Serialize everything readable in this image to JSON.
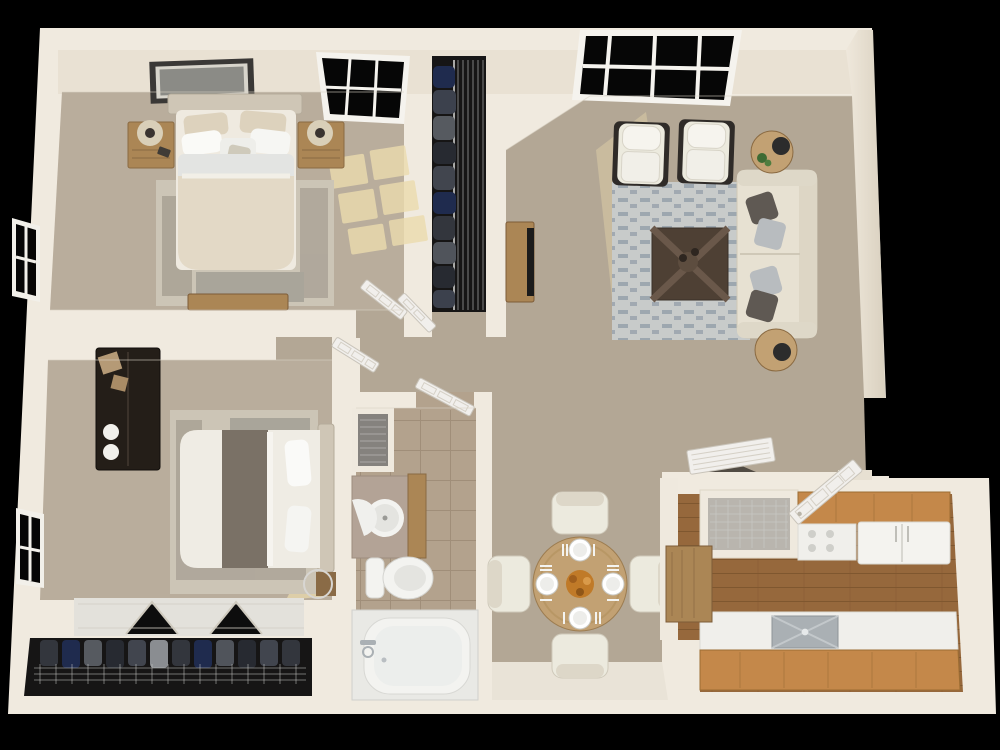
{
  "scene": {
    "description": "Photorealistic 3D dollhouse-style top-down floor plan render of a two-bedroom, one-bathroom apartment on a black background",
    "view": "overhead 3D floor plan",
    "bedrooms": 2,
    "bathrooms": 1,
    "background": "#000000"
  },
  "palette": {
    "background": "#000000",
    "wall": "#f0eadf",
    "wall_face": "#e9e1d3",
    "wall_shade": "#ddd4c3",
    "carpet": "#b3a795",
    "carpet_bedroom": "#b9ad9c",
    "vinyl": "#e9e3d7",
    "tile": "#b3a28d",
    "rug_bedroom": "#ccc5b6",
    "rug_living": "#c8cbca",
    "rug_pattern": "#8f9aa5",
    "wood_floor": "#96683c",
    "cabinet_wood": "#c4884a",
    "counter": "#f0efeb",
    "wood_light": "#c2a173",
    "wood_mid": "#ab8655",
    "table_dark": "#4e4034",
    "armoire": "#241e18",
    "closet_dark": "#161515",
    "sofa": "#e7e1d2",
    "chair": "#eceade",
    "pillow_dark": "#5f5953",
    "pillow_light": "#b8bcbf",
    "fixture": "#f3f3f0",
    "steel": "#aab0b4",
    "door": "#f1efec",
    "sunlight": "#ecdcae",
    "plant": "#3e6b34",
    "flower": "#c07a28",
    "frame": "#3a3836",
    "photo": "#8b8b86",
    "glass": "#060606"
  },
  "rooms": [
    {
      "id": "bedroom-1",
      "label": "Bedroom 1",
      "position": "top-left",
      "contents": [
        "queen bed with beige duvet",
        "two wood nightstands",
        "two table lamps",
        "framed wall art",
        "distressed area rug",
        "storage bench",
        "window on top wall",
        "window on left wall",
        "sunlight patch on carpet"
      ]
    },
    {
      "id": "bedroom-1-closet",
      "label": "Bedroom 1 Closet",
      "position": "top-center",
      "contents": [
        "hanging clothes",
        "wire shelving rack"
      ]
    },
    {
      "id": "living-room",
      "label": "Living Room",
      "position": "top-right",
      "contents": [
        "cream sofa with throw pillows",
        "two white accent chairs with dark frames",
        "dark wood coffee table",
        "two round side tables",
        "table lamp",
        "potted plant",
        "patterned area rug",
        "tv console with television",
        "large window on top wall"
      ]
    },
    {
      "id": "hallway",
      "label": "Hallway",
      "position": "center",
      "contents": [
        "bedroom doors",
        "closet door"
      ]
    },
    {
      "id": "bedroom-2",
      "label": "Bedroom 2",
      "position": "bottom-left",
      "contents": [
        "queen bed with gray blanket",
        "dark armoire with decor jars",
        "distressed area rug",
        "bifold closet doors",
        "window on left wall"
      ]
    },
    {
      "id": "bedroom-2-closet",
      "label": "Bedroom 2 Closet",
      "position": "bottom-left",
      "contents": [
        "hanging clothes",
        "wire shelf"
      ]
    },
    {
      "id": "bathroom",
      "label": "Bathroom",
      "position": "bottom-center",
      "contents": [
        "vanity with round sink",
        "toilet",
        "bathtub with faucet",
        "linen closet with wire shelves",
        "tile floor",
        "inward-swinging door"
      ]
    },
    {
      "id": "dining-area",
      "label": "Dining Area",
      "position": "bottom-center-right",
      "contents": [
        "round wood dining table",
        "four upholstered chairs",
        "four place settings with plates and cutlery",
        "orange floral centerpiece"
      ]
    },
    {
      "id": "kitchen",
      "label": "Kitchen",
      "position": "bottom-right",
      "contents": [
        "upper wood cabinets",
        "range",
        "refrigerator",
        "stainless sink in white counter",
        "wood base cabinets",
        "pantry with wire shelf",
        "breakfast bar with wood top",
        "plank wood floor",
        "louvered pantry door leaning open"
      ]
    },
    {
      "id": "entry",
      "label": "Entry",
      "position": "right",
      "contents": [
        "open white six-panel front door",
        "doorway opening"
      ]
    }
  ]
}
